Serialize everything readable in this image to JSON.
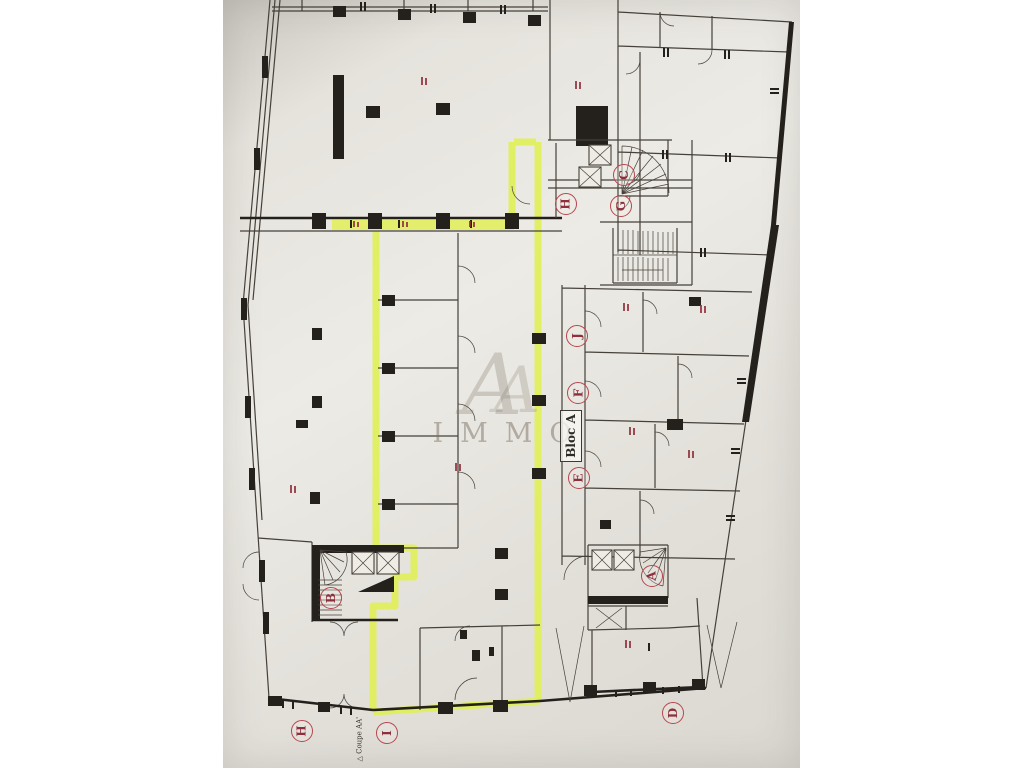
{
  "page": {
    "type": "architectural floor plan photo"
  },
  "watermark": {
    "brand": "IMMO",
    "monogram": "A"
  },
  "plan": {
    "bloc_label": "Bloc A",
    "section_label": "△ Coupe AA'",
    "markers": [
      {
        "id": "H-upper",
        "label": "H"
      },
      {
        "id": "C",
        "label": "C"
      },
      {
        "id": "G",
        "label": "G"
      },
      {
        "id": "J",
        "label": "J"
      },
      {
        "id": "F",
        "label": "F"
      },
      {
        "id": "E",
        "label": "E"
      },
      {
        "id": "A",
        "label": "A"
      },
      {
        "id": "B",
        "label": "B"
      },
      {
        "id": "H-lower",
        "label": "H"
      },
      {
        "id": "I",
        "label": "I"
      },
      {
        "id": "D",
        "label": "D"
      }
    ]
  },
  "theme": {
    "paper": "#e6e3dc",
    "wall": "#45413a",
    "wall_dark": "#24211c",
    "highlight": "#e0ef57",
    "marker_red": "#8f2f3c",
    "marker_ring": "#b8454e",
    "watermark": "rgba(122,112,97,0.5)"
  }
}
